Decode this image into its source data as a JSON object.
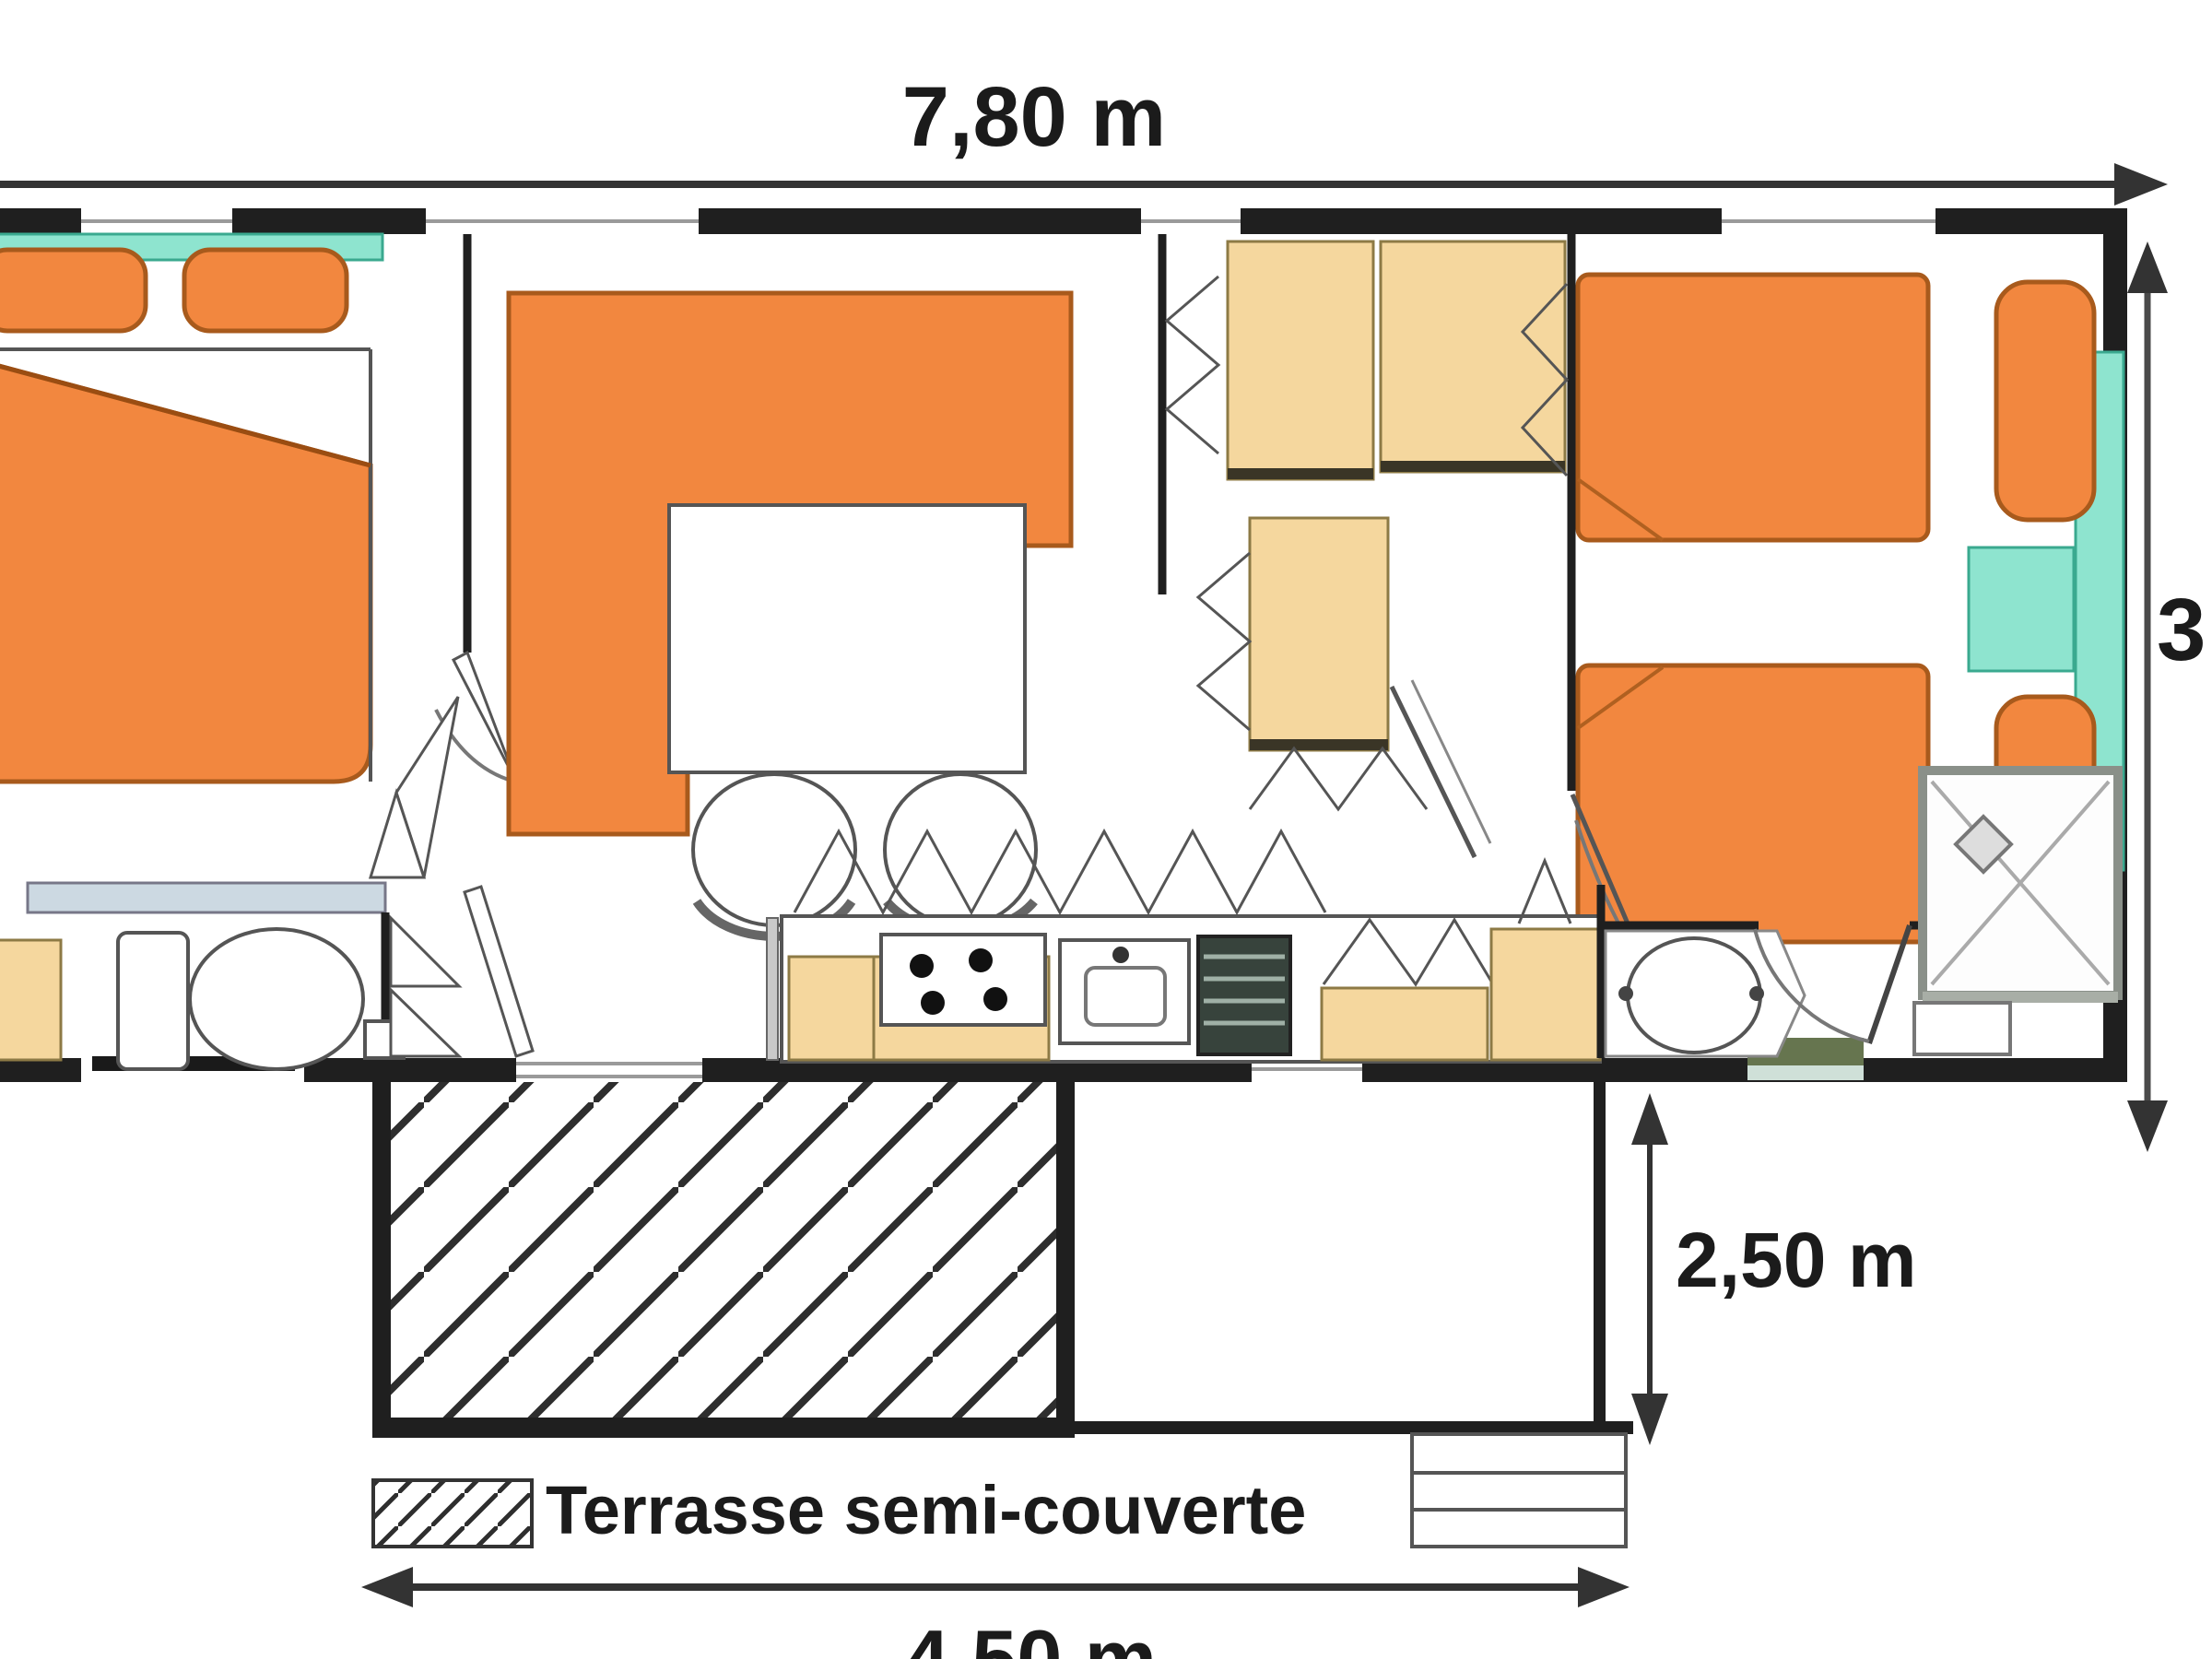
{
  "plan": {
    "type": "floor-plan",
    "dimensions": {
      "width_label": "7,80 m",
      "height_label": "3",
      "terrace_depth_label": "2,50 m",
      "terrace_width_label": "4,50 m"
    },
    "legend": {
      "label": "Terrasse semi-couverte"
    },
    "colors": {
      "paper": "#ffffff",
      "ink": "#1b1b1b",
      "wall": "#1f1f1f",
      "accent_orange": "#f2873f",
      "tan": "#f5d79e",
      "teal": "#8ee4cf",
      "hatch": "#2e2e2e",
      "window_olive": "#66754f",
      "shelf_blue": "#ccd9e2"
    },
    "elements": [
      "master-bed",
      "pillows",
      "headboard-shelf",
      "corner-sofa",
      "dining-table",
      "chairs",
      "wardrobes",
      "bunk-cabinets",
      "twin-beds",
      "nightstand",
      "kitchen-counter",
      "stove",
      "sink",
      "fridge",
      "toilet",
      "washbasin",
      "shower",
      "terrace-hatched",
      "terrace-open",
      "steps",
      "doors",
      "windows"
    ]
  }
}
